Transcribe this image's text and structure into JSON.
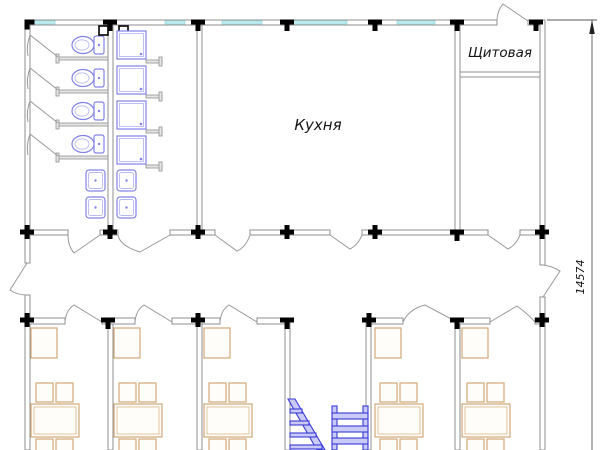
{
  "labels": {
    "kitchen": "Кухня",
    "switchboard_room": "Щитовая"
  },
  "dimension": {
    "value": "14574"
  },
  "fixtures": {
    "toilets": 4,
    "shower_cabins": 4,
    "washbasins": 4,
    "rooms_with_tables": 5
  },
  "colors": {
    "wall": "#8f8f8f",
    "door": "#9a9a9a",
    "window": "#c4eef2",
    "window-edge": "#8fd8de",
    "node": "#2424cc",
    "node-fill": "#d4d4fb",
    "fixture": "#8383e8",
    "fixture-light": "#b9b9f2",
    "furniture": "#d3a878",
    "stairs": "#3a3ad6",
    "stairs-fill": "#cacaf8",
    "ink": "#141414",
    "dim": "#5a5a5a"
  }
}
